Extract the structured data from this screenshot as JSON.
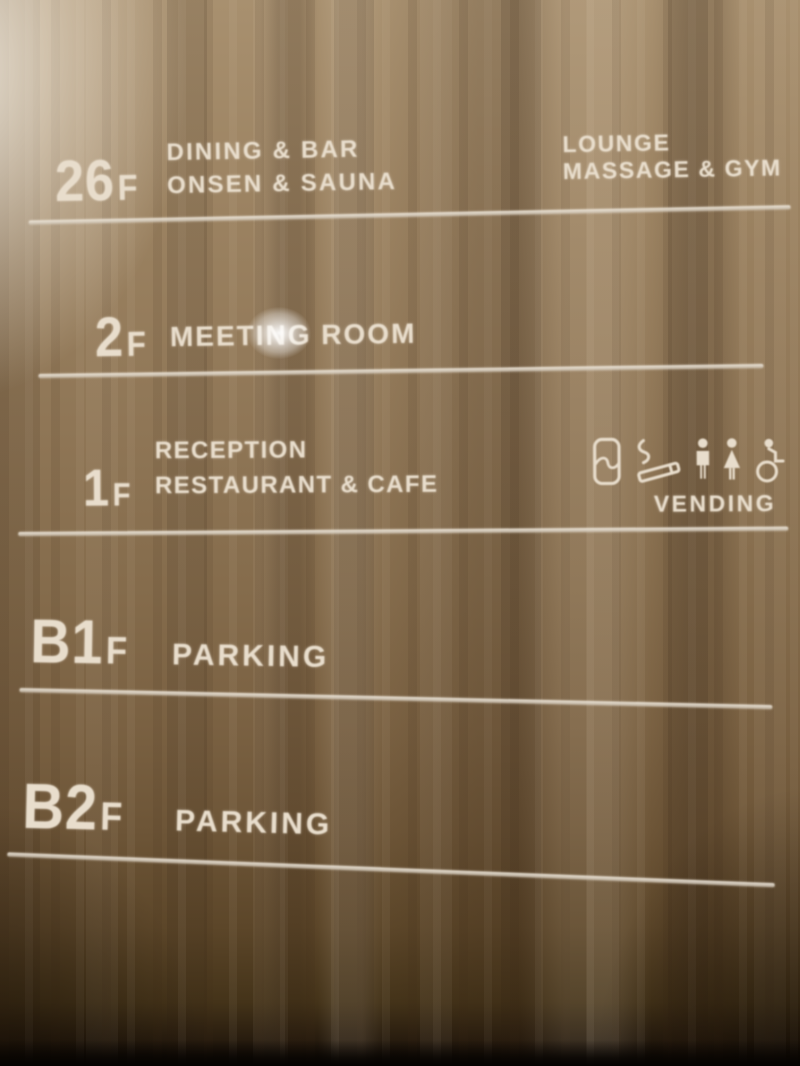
{
  "sign": {
    "floors": [
      {
        "number": "26",
        "suffix": "F",
        "lines": [
          "DINING & BAR",
          "ONSEN & SAUNA"
        ],
        "right_lines": [
          "LOUNGE",
          "MASSAGE & GYM"
        ]
      },
      {
        "number": "2",
        "suffix": "F",
        "lines": [
          "MEETING ROOM"
        ]
      },
      {
        "number": "1",
        "suffix": "F",
        "lines": [
          "RECEPTION",
          "RESTAURANT & CAFE"
        ],
        "facility_label": "VENDING",
        "icons": [
          "vending-machine",
          "smoking-area",
          "mens-restroom",
          "womens-restroom",
          "accessible-restroom"
        ]
      },
      {
        "number": "B1",
        "suffix": "F",
        "lines": [
          "PARKING"
        ]
      },
      {
        "number": "B2",
        "suffix": "F",
        "lines": [
          "PARKING"
        ]
      }
    ],
    "colors": {
      "text": "#e8ddcc",
      "wood_top": "#a8906f",
      "wood_bottom": "#0b0703"
    }
  }
}
